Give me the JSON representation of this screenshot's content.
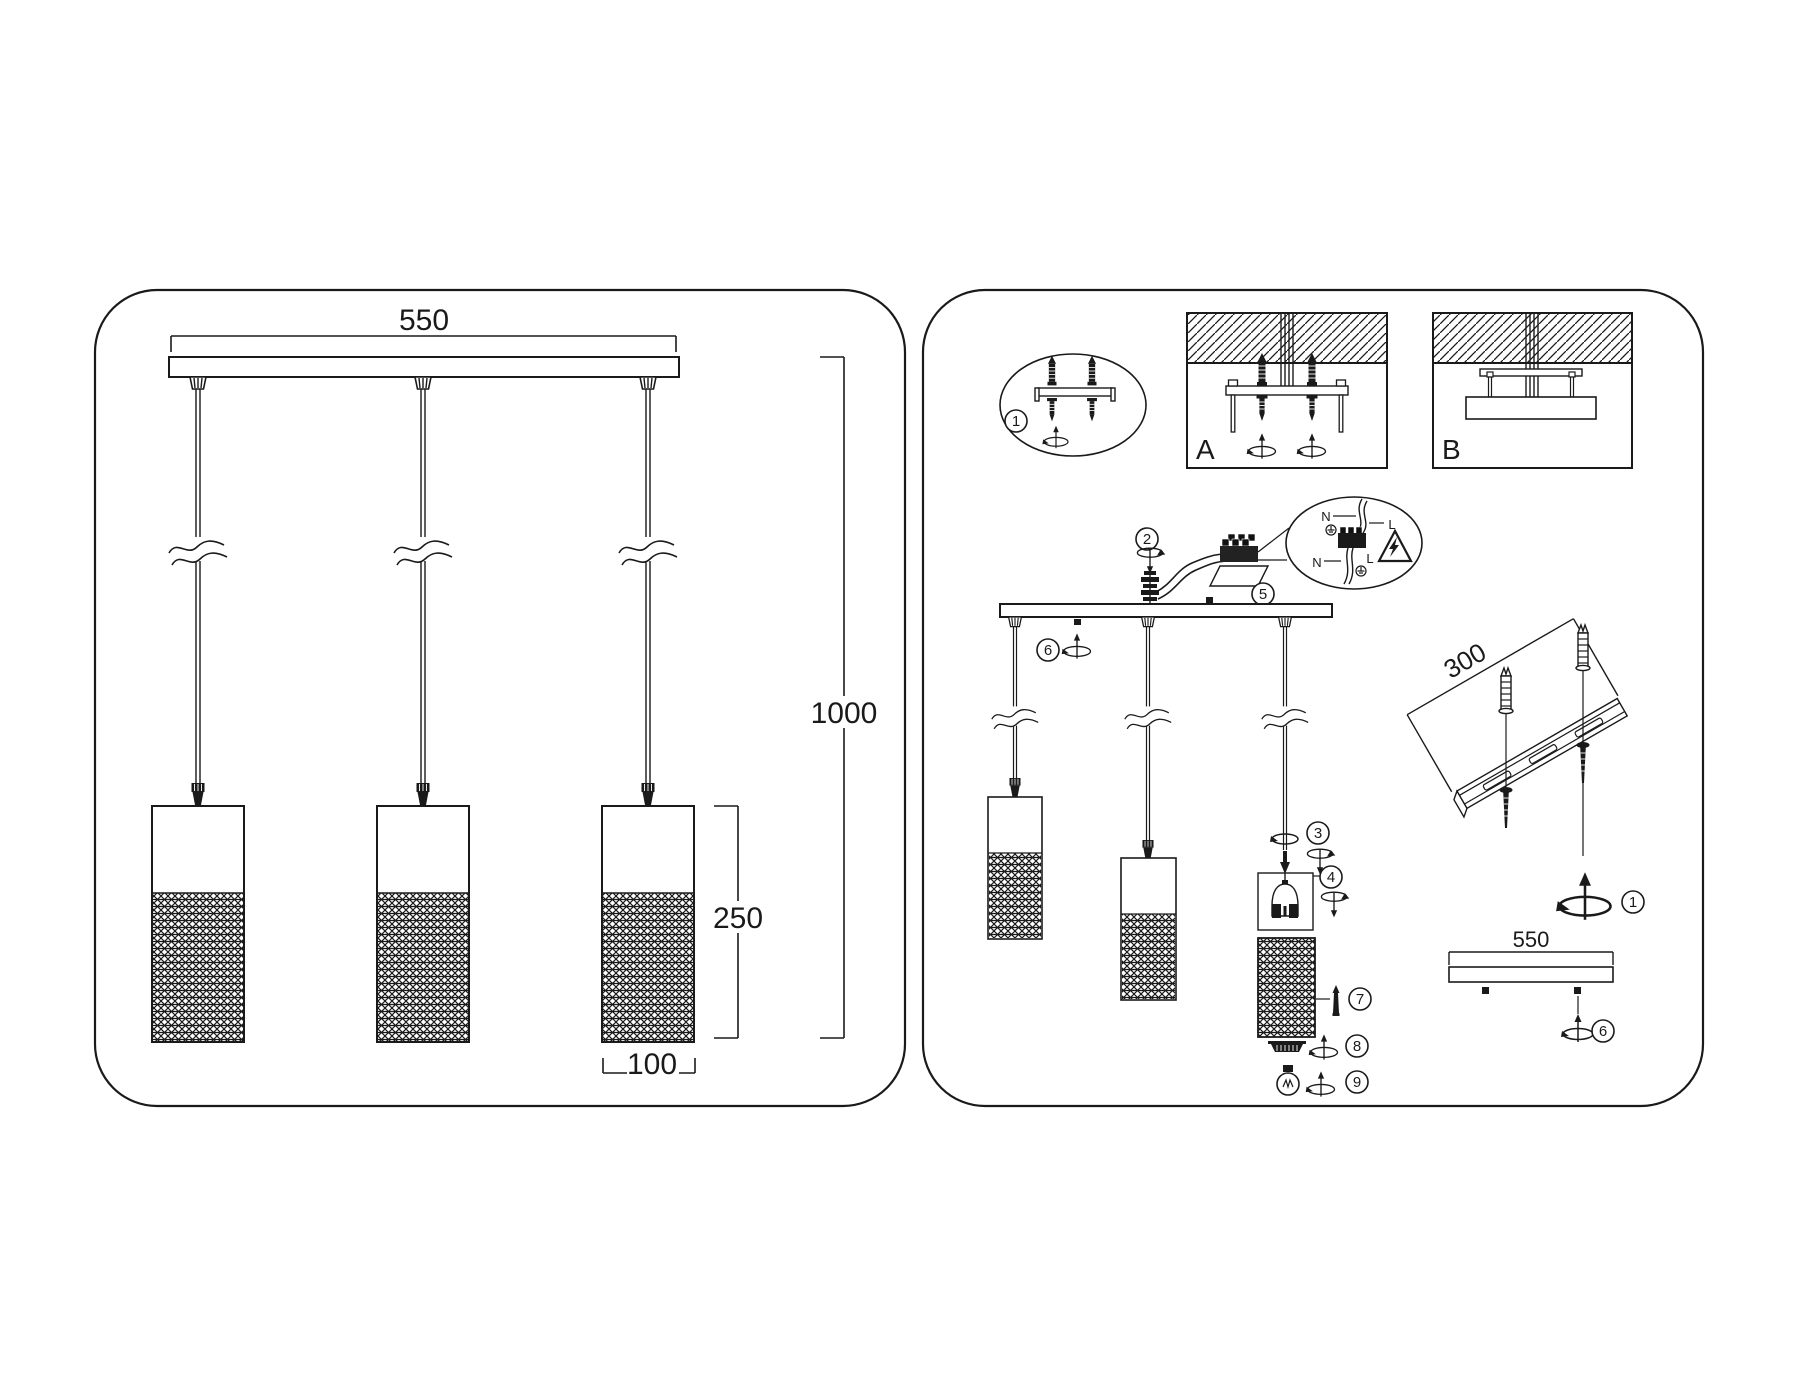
{
  "drawing": {
    "colors": {
      "ink": "#1a1a1a",
      "paper": "#ffffff"
    },
    "left_panel": {
      "dim_overall_width": "550",
      "dim_overall_height": "1000",
      "dim_shade_height": "250",
      "dim_shade_diameter": "100"
    },
    "right_panel": {
      "mount_option_a_label": "A",
      "mount_option_b_label": "B",
      "rail_dim": "300",
      "canopy_dim": "550",
      "steps": {
        "1": "1",
        "2": "2",
        "3": "3",
        "4": "4",
        "5": "5",
        "6": "6",
        "7": "7",
        "8": "8",
        "9": "9"
      },
      "wiring_labels": {
        "neutral_top": "N",
        "line_top": "L",
        "neutral_bottom": "N",
        "line_bottom": "L"
      }
    }
  }
}
